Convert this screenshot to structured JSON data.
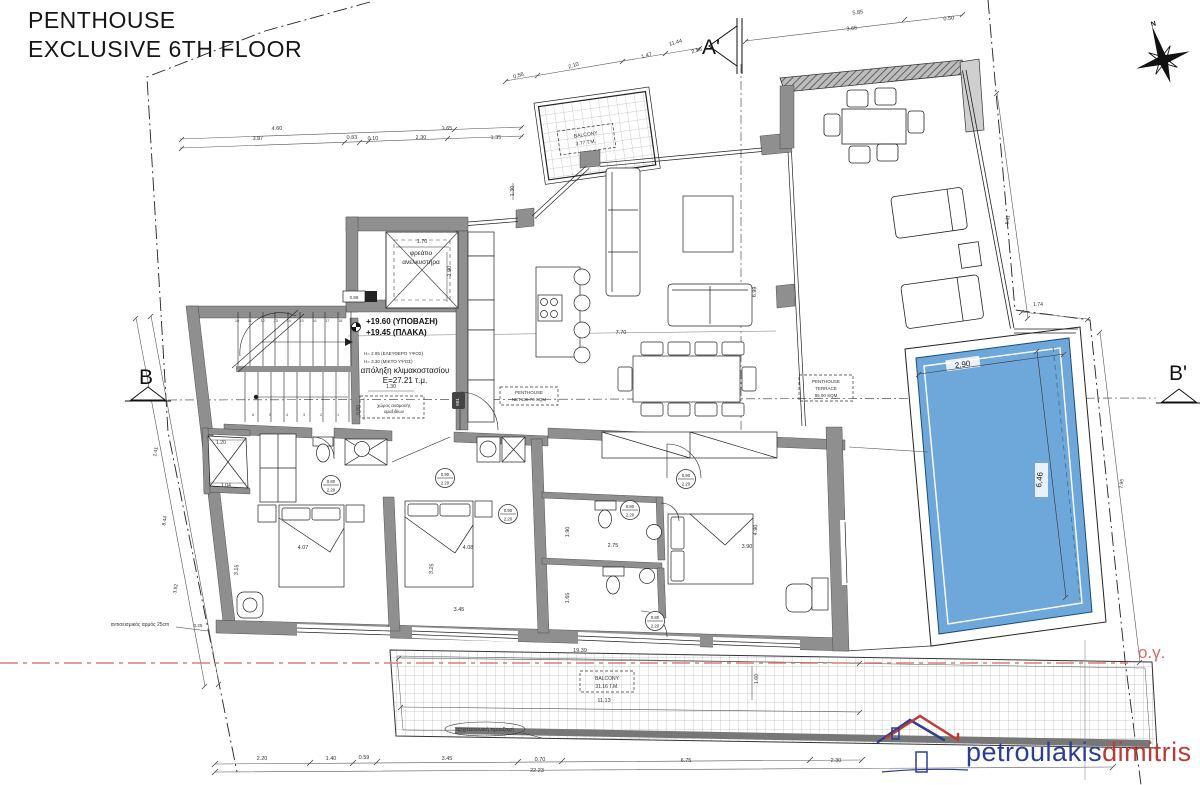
{
  "title": {
    "line1": "PENTHOUSE",
    "line2": "EXCLUSIVE 6TH FLOOR"
  },
  "markers": {
    "a": "A'",
    "b": "B",
    "b2": "B'",
    "north": "N",
    "building_line": "ο.γ."
  },
  "logo": {
    "word1": "petroulakis",
    "word2": "dimitris"
  },
  "colors": {
    "pool": "#6ea7d9",
    "wall": "#8f8f8f",
    "red_line": "#dd7b76",
    "logo_blue": "#2b3f92",
    "logo_red": "#bc3b34"
  },
  "rooms": {
    "elevator": "φρεάτιο ανελκυστήρα",
    "stair_exit": "απόληξη κλιμακοστασίου E=27.21 τ.μ.",
    "penthouse_net": "PENTHOUSE NET136.70 SQM",
    "terrace": "PENTHOUSE TERRACE 85.00 SQM",
    "balcony_top": "BALCONY 3.77 T.M.",
    "balcony_bottom": "BALCONY 31.16 T.M."
  },
  "stairs": {
    "upper": [
      "10",
      "11",
      "12",
      "13",
      "14",
      "15",
      "16",
      "17",
      "18"
    ],
    "lower": [
      "6",
      "5",
      "4",
      "3",
      "2",
      "1"
    ]
  },
  "door_labels": [
    {
      "top": "0.80",
      "bottom": "2.20",
      "x": 331,
      "y": 485
    },
    {
      "top": "0.90",
      "bottom": "2.20",
      "x": 445,
      "y": 478
    },
    {
      "top": "0.90",
      "bottom": "2.20",
      "x": 508,
      "y": 514
    },
    {
      "top": "0.80",
      "bottom": "2.20",
      "x": 630,
      "y": 510
    },
    {
      "top": "0.80",
      "bottom": "2.20",
      "x": 655,
      "y": 621
    },
    {
      "top": "0.90",
      "bottom": "2.20",
      "x": 686,
      "y": 479
    }
  ],
  "annotations": [
    {
      "t": "0.56",
      "x": 519,
      "y": 77,
      "r": -17,
      "s": 5.5
    },
    {
      "t": "2.10",
      "x": 574,
      "y": 67,
      "r": -17,
      "s": 5.5
    },
    {
      "t": "1.47",
      "x": 647,
      "y": 57,
      "r": -16,
      "s": 5.5
    },
    {
      "t": "11.44",
      "x": 676,
      "y": 44,
      "r": -16,
      "s": 5.5
    },
    {
      "t": "2.56",
      "x": 697,
      "y": 52,
      "r": -16,
      "s": 5.5
    },
    {
      "t": "5.85",
      "x": 858,
      "y": 14,
      "r": -7,
      "s": 5.5
    },
    {
      "t": "3.66",
      "x": 852,
      "y": 30,
      "r": -7,
      "s": 5.5
    },
    {
      "t": "0.50",
      "x": 949,
      "y": 20,
      "r": -7,
      "s": 5.5
    },
    {
      "t": "4.60",
      "x": 277,
      "y": 130,
      "r": -2,
      "s": 5.5
    },
    {
      "t": "3.87",
      "x": 258,
      "y": 140,
      "r": -2,
      "s": 5.5
    },
    {
      "t": "0.83",
      "x": 352,
      "y": 139,
      "r": -2,
      "s": 5.5
    },
    {
      "t": "0.10",
      "x": 373,
      "y": 140,
      "r": -2,
      "s": 5.5
    },
    {
      "t": "2.30",
      "x": 421,
      "y": 139,
      "r": -2,
      "s": 5.5
    },
    {
      "t": "3.65",
      "x": 447,
      "y": 130,
      "r": -2,
      "s": 5.5
    },
    {
      "t": "1.35",
      "x": 496,
      "y": 139,
      "r": -2,
      "s": 5.5
    },
    {
      "t": "1.30",
      "x": 514,
      "y": 191,
      "r": -90,
      "s": 5.5
    },
    {
      "t": "1.70",
      "x": 422,
      "y": 243,
      "s": 5.5
    },
    {
      "t": "1.90",
      "x": 451,
      "y": 271,
      "r": -90,
      "s": 5.5
    },
    {
      "t": "1.30",
      "x": 391,
      "y": 388,
      "s": 5
    },
    {
      "t": "0.80",
      "x": 360,
      "y": 410,
      "r": -90,
      "s": 5
    },
    {
      "t": "0.89",
      "x": 354,
      "y": 299,
      "s": 4.5
    },
    {
      "t": "1.20",
      "x": 221,
      "y": 444,
      "s": 5
    },
    {
      "t": "1.04",
      "x": 226,
      "y": 487,
      "s": 5
    },
    {
      "t": "1.41",
      "x": 157,
      "y": 452,
      "r": -80,
      "s": 5
    },
    {
      "t": "8.44",
      "x": 166,
      "y": 521,
      "r": -80,
      "s": 5
    },
    {
      "t": "3.92",
      "x": 177,
      "y": 589,
      "r": -80,
      "s": 5
    },
    {
      "t": "4.07",
      "x": 303,
      "y": 549,
      "s": 5.5
    },
    {
      "t": "3.15",
      "x": 238,
      "y": 570,
      "r": -85,
      "s": 5.5
    },
    {
      "t": "4.08",
      "x": 468,
      "y": 549,
      "s": 5.5
    },
    {
      "t": "3.25",
      "x": 433,
      "y": 569,
      "r": -85,
      "s": 5.5
    },
    {
      "t": "3.45",
      "x": 459,
      "y": 611,
      "s": 5.5
    },
    {
      "t": "2.75",
      "x": 613,
      "y": 547,
      "s": 5.5
    },
    {
      "t": "1.90",
      "x": 569,
      "y": 532,
      "r": -88,
      "s": 5.5
    },
    {
      "t": "1.65",
      "x": 569,
      "y": 598,
      "r": -88,
      "s": 5.5
    },
    {
      "t": "3.90",
      "x": 747,
      "y": 548,
      "s": 5.5
    },
    {
      "t": "4.90",
      "x": 757,
      "y": 530,
      "r": -88,
      "s": 5.5
    },
    {
      "t": "7.70",
      "x": 621,
      "y": 334,
      "s": 5.5
    },
    {
      "t": "6.99",
      "x": 756,
      "y": 292,
      "r": -88,
      "s": 5.5
    },
    {
      "t": "19.39",
      "x": 580,
      "y": 652,
      "s": 5.5
    },
    {
      "t": "11.13",
      "x": 604,
      "y": 702,
      "s": 5.5
    },
    {
      "t": "1.60",
      "x": 758,
      "y": 679,
      "r": -90,
      "s": 5
    },
    {
      "t": "2.20",
      "x": 262,
      "y": 760,
      "s": 5.5
    },
    {
      "t": "1.40",
      "x": 331,
      "y": 760,
      "s": 5.5
    },
    {
      "t": "0.59",
      "x": 364,
      "y": 759,
      "s": 5.5
    },
    {
      "t": "3.45",
      "x": 447,
      "y": 760,
      "s": 5.5
    },
    {
      "t": "0.70",
      "x": 540,
      "y": 761,
      "s": 5.5
    },
    {
      "t": "6.75",
      "x": 686,
      "y": 762,
      "s": 5.5
    },
    {
      "t": "2.30",
      "x": 836,
      "y": 762,
      "s": 5.5
    },
    {
      "t": "22.23",
      "x": 537,
      "y": 772,
      "s": 5.5
    },
    {
      "t": "5.11",
      "x": 1009,
      "y": 220,
      "r": -83,
      "s": 5
    },
    {
      "t": "1.74",
      "x": 1038,
      "y": 306,
      "s": 5
    },
    {
      "t": "7.95",
      "x": 1123,
      "y": 484,
      "r": -84,
      "s": 5
    },
    {
      "t": "0.25",
      "x": 198,
      "y": 627,
      "s": 4.5
    },
    {
      "t": "2,90",
      "x": 963,
      "y": 367,
      "s": 8,
      "r": -8,
      "c": "#222"
    },
    {
      "t": "6,46",
      "x": 1042,
      "y": 480,
      "s": 8,
      "r": -84,
      "c": "#222"
    },
    {
      "t": "φρεάτιο",
      "x": 421,
      "y": 255,
      "s": 6.5,
      "c": "#222"
    },
    {
      "t": "ανελκυστήρα",
      "x": 421,
      "y": 264,
      "s": 6.5,
      "c": "#222"
    },
    {
      "t": "+19.60 (ΥΠΟΒΑΣΗ)",
      "x": 366,
      "y": 324,
      "s": 8,
      "a": "start",
      "c": "#111",
      "w": "bold"
    },
    {
      "t": "+19.45 (ΠΛΑΚΑ)",
      "x": 366,
      "y": 335,
      "s": 8,
      "a": "start",
      "c": "#111",
      "w": "bold"
    },
    {
      "t": "H= 2.95 (ΕΛΕΥΘΕΡΟ ΥΨΟΣ)",
      "x": 364,
      "y": 355,
      "s": 4.5,
      "a": "start"
    },
    {
      "t": "H= 3.30 (ΜΙΚΤΟ ΥΨΟΣ)",
      "x": 364,
      "y": 363,
      "s": 4.5,
      "a": "start"
    },
    {
      "t": "απόληξη κλιμακοστασίου",
      "x": 405,
      "y": 373,
      "s": 8,
      "c": "#111"
    },
    {
      "t": "E=27.21 τ.μ.",
      "x": 405,
      "y": 383,
      "s": 8,
      "c": "#111"
    },
    {
      "t": "χώρος αναμονής",
      "x": 394,
      "y": 407,
      "s": 4.5
    },
    {
      "t": "αμαξιδίων",
      "x": 394,
      "y": 413,
      "s": 4.5
    },
    {
      "t": "PENTHOUSE",
      "x": 529,
      "y": 394,
      "s": 4.5
    },
    {
      "t": "NET136.70 SQM",
      "x": 529,
      "y": 401,
      "s": 4.5
    },
    {
      "t": "PENTHOUSE",
      "x": 826,
      "y": 383,
      "s": 4.5
    },
    {
      "t": "TERRACE",
      "x": 826,
      "y": 390,
      "s": 4.5
    },
    {
      "t": "85.00 SQM",
      "x": 826,
      "y": 397,
      "s": 4.5
    },
    {
      "t": "BALCONY",
      "x": 586,
      "y": 136,
      "s": 5,
      "r": -8
    },
    {
      "t": "3.77 T.M.",
      "x": 586,
      "y": 144,
      "s": 5,
      "r": -8
    },
    {
      "t": "BALCONY",
      "x": 607,
      "y": 680,
      "s": 5
    },
    {
      "t": "31.16 T.M.",
      "x": 607,
      "y": 688,
      "s": 5
    },
    {
      "t": "αρχιτεκτονική προεξοχή",
      "x": 485,
      "y": 731,
      "s": 5.5
    },
    {
      "t": "αντισεισμικός αρμός 25cm",
      "x": 140,
      "y": 626,
      "s": 5
    },
    {
      "t": "501",
      "x": 459,
      "y": 402,
      "s": 4.5,
      "r": -90,
      "c": "#fff"
    },
    {
      "t": "N",
      "x": 1154,
      "y": 26,
      "s": 7,
      "w": "bold",
      "r": -15,
      "c": "#111"
    }
  ]
}
